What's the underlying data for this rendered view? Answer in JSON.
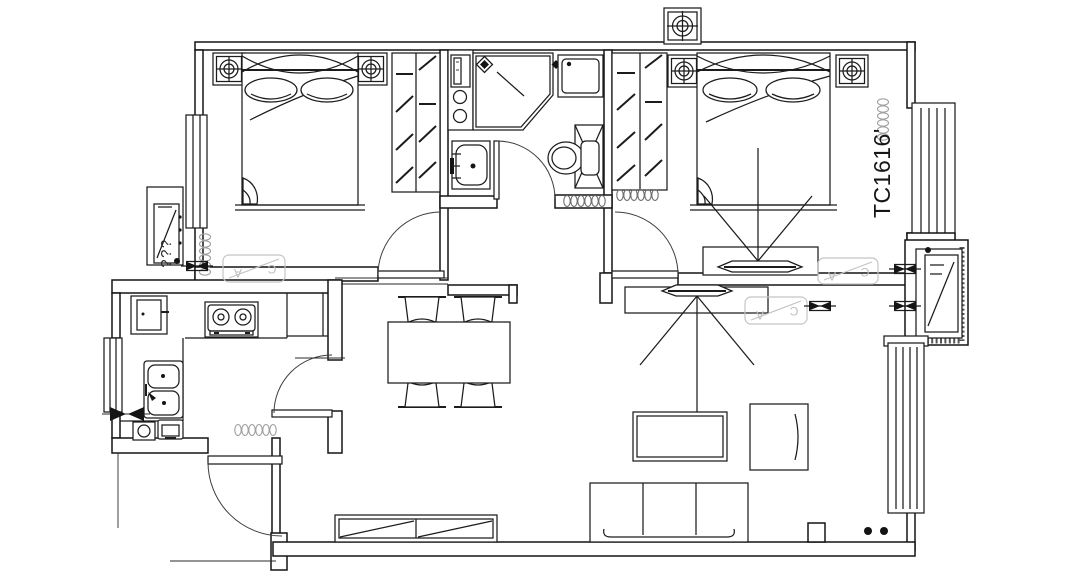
{
  "plan": {
    "labels": {
      "unit": "TC1616'",
      "ac_outdoor": "???",
      "ghost_a": "A",
      "ghost_c": "C"
    },
    "colors": {
      "line": "#141414",
      "radiator_gray": "#a0a0a0",
      "ghost_gray": "#c4c4c4",
      "background": "#ffffff"
    },
    "fixtures": [
      "double-bed",
      "pillow",
      "nightstand-with-lamp",
      "wardrobe",
      "flue-shaft",
      "shower-enclosure",
      "floor-drain",
      "washing-machine",
      "water-heater-cabinet",
      "bathroom-vanity",
      "toilet",
      "towel-radiator",
      "door-swing",
      "radiator",
      "outdoor-ac-unit",
      "ghost-wall-ac",
      "window",
      "balcony-window",
      "sliding-window",
      "kitchen-counter",
      "gas-stove",
      "kitchen-sink",
      "refrigerator",
      "small-appliance",
      "dining-table",
      "stool",
      "tv-with-viewing-lines",
      "tv-cabinet",
      "coffee-table",
      "armchair",
      "sofa",
      "entry-door",
      "wall-tie-symbol",
      "section-arrows",
      "floor-dots"
    ]
  }
}
